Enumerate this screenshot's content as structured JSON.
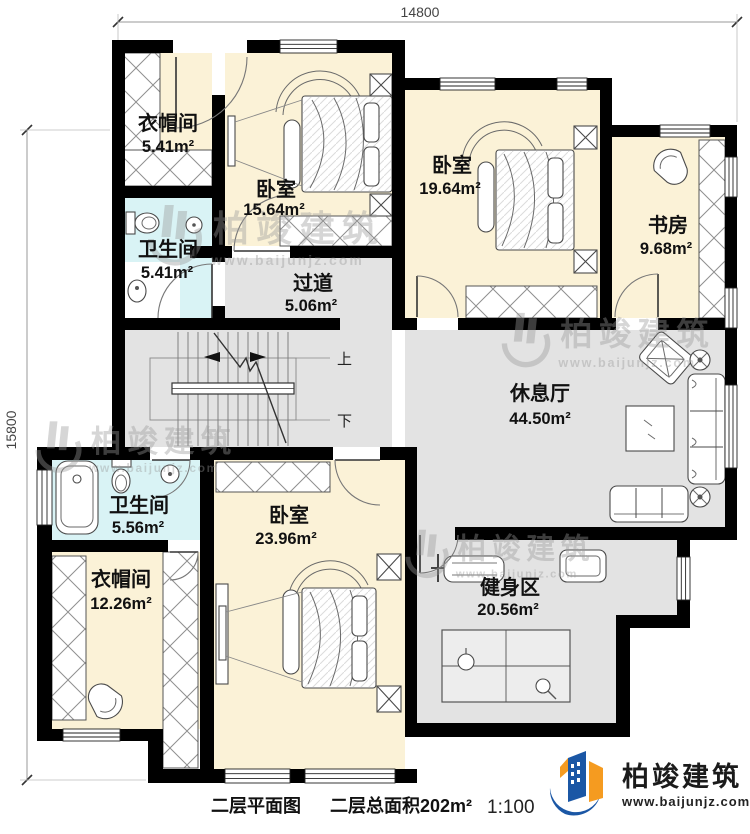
{
  "plan": {
    "dimensions": {
      "top": "14800",
      "left": "15800"
    },
    "rooms": [
      {
        "id": "cloakroom-top",
        "name": "衣帽间",
        "area": "5.41m²"
      },
      {
        "id": "bedroom-top",
        "name": "卧室",
        "area": "15.64m²"
      },
      {
        "id": "bedroom-right",
        "name": "卧室",
        "area": "19.64m²"
      },
      {
        "id": "study",
        "name": "书房",
        "area": "9.68m²"
      },
      {
        "id": "bathroom-top",
        "name": "卫生间",
        "area": "5.41m²"
      },
      {
        "id": "hallway",
        "name": "过道",
        "area": "5.06m²"
      },
      {
        "id": "lounge",
        "name": "休息厅",
        "area": "44.50m²"
      },
      {
        "id": "bathroom-bottom",
        "name": "卫生间",
        "area": "5.56m²"
      },
      {
        "id": "cloakroom-bottom",
        "name": "衣帽间",
        "area": "12.26m²"
      },
      {
        "id": "bedroom-bottom",
        "name": "卧室",
        "area": "23.96m²"
      },
      {
        "id": "gym",
        "name": "健身区",
        "area": "20.56m²"
      }
    ],
    "stairs": {
      "up": "上",
      "down": "下"
    },
    "caption": {
      "drawing_title": "二层平面图",
      "total_area": "二层总面积202m²",
      "scale": "1:100"
    },
    "brand": {
      "name": "柏竣建筑",
      "website": "www.baijunjz.com"
    },
    "watermark": {
      "name": "柏竣建筑",
      "website": "www.baijunjz.com"
    },
    "colors": {
      "room_fill": "#FBF2D7",
      "bath_fill": "#D9F3F5",
      "floor_fill": "#E3E3E3",
      "wall": "#000000",
      "logo_blue": "#1B57A5",
      "logo_orange": "#F59B20"
    }
  }
}
